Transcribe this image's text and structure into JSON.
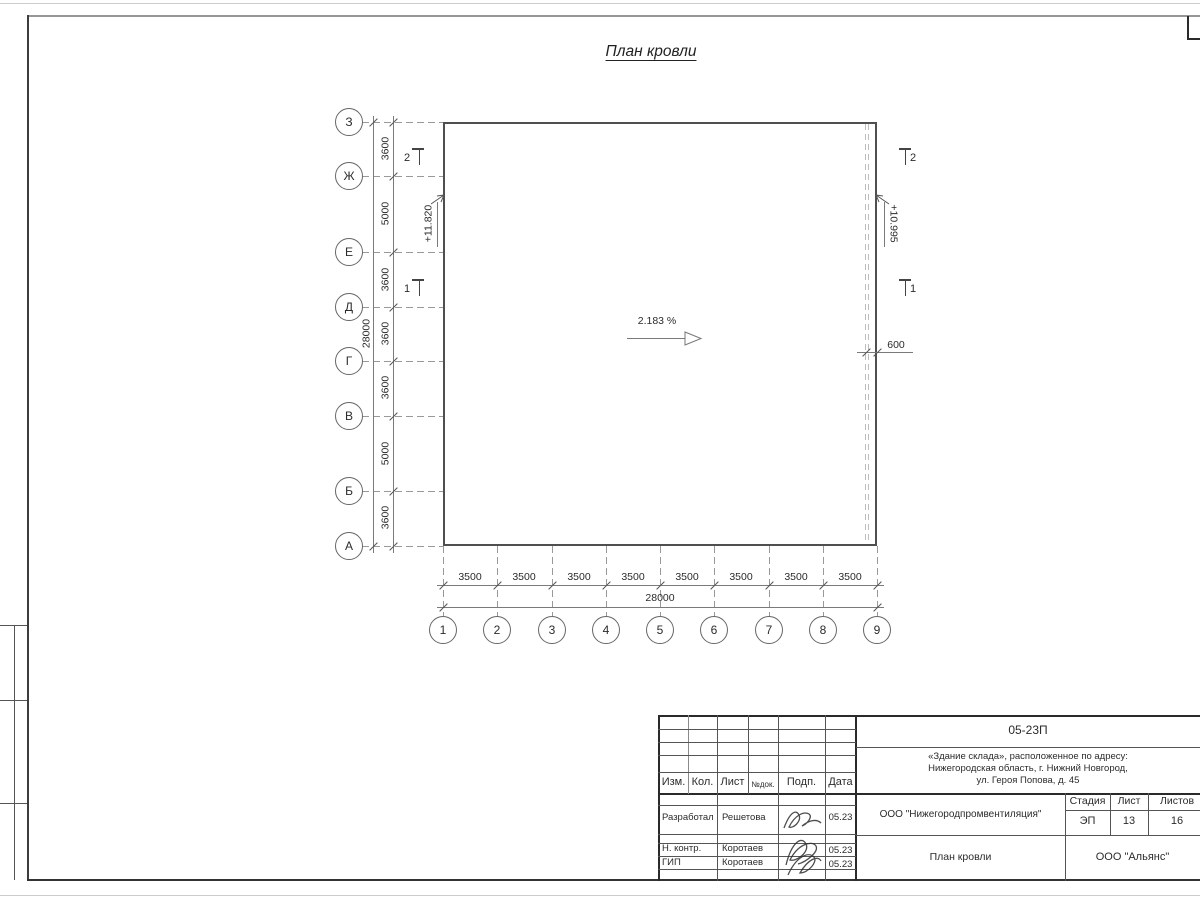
{
  "heading": "План кровли",
  "colors": {
    "frame_line": "#3d3d3d",
    "building_line": "#4f4f4f",
    "text": "#2b2b2b"
  },
  "plan": {
    "axis_letters": [
      "З",
      "Ж",
      "Е",
      "Д",
      "Г",
      "В",
      "Б",
      "А"
    ],
    "axis_numbers": [
      "1",
      "2",
      "3",
      "4",
      "5",
      "6",
      "7",
      "8",
      "9"
    ],
    "dims_left": [
      "3600",
      "5000",
      "3600",
      "3600",
      "3600",
      "5000",
      "3600"
    ],
    "total_left": "28000",
    "dims_bottom": [
      "3500",
      "3500",
      "3500",
      "3500",
      "3500",
      "3500",
      "3500",
      "3500"
    ],
    "total_bottom": "28000",
    "slope": "2.183 %",
    "elevation_left": "+11.820",
    "elevation_right": "+10.995",
    "overhang": "600",
    "section_left_top": "2",
    "section_left_bottom": "1",
    "section_right_top": "2",
    "section_right_bottom": "1"
  },
  "title_block": {
    "doc_number": "05-23П",
    "project_address_lines": [
      "«Здание склада», расположенное по адресу:",
      "Нижегородская область, г. Нижний Новгород,",
      "ул. Героя Попова, д. 45"
    ],
    "columns": {
      "izm": "Изм.",
      "kol": "Кол.",
      "list": "Лист",
      "ndok": "№док.",
      "podp": "Подп.",
      "data": "Дата"
    },
    "signature_rows": [
      {
        "role": "Разработал",
        "name": "Решетова",
        "date": "05.23"
      },
      {
        "role": "Н. контр.",
        "name": "Коротаев",
        "date": "05.23"
      },
      {
        "role": "ГИП",
        "name": "Коротаев",
        "date": "05.23"
      }
    ],
    "designer_company": "ООО \"Нижегородпромвентиляция\"",
    "stage_label": "Стадия",
    "sheet_label": "Лист",
    "sheets_label": "Листов",
    "stage": "ЭП",
    "sheet_number": "13",
    "sheets_total": "16",
    "drawing_name": "План кровли",
    "client_company": "ООО \"Альянс\""
  }
}
